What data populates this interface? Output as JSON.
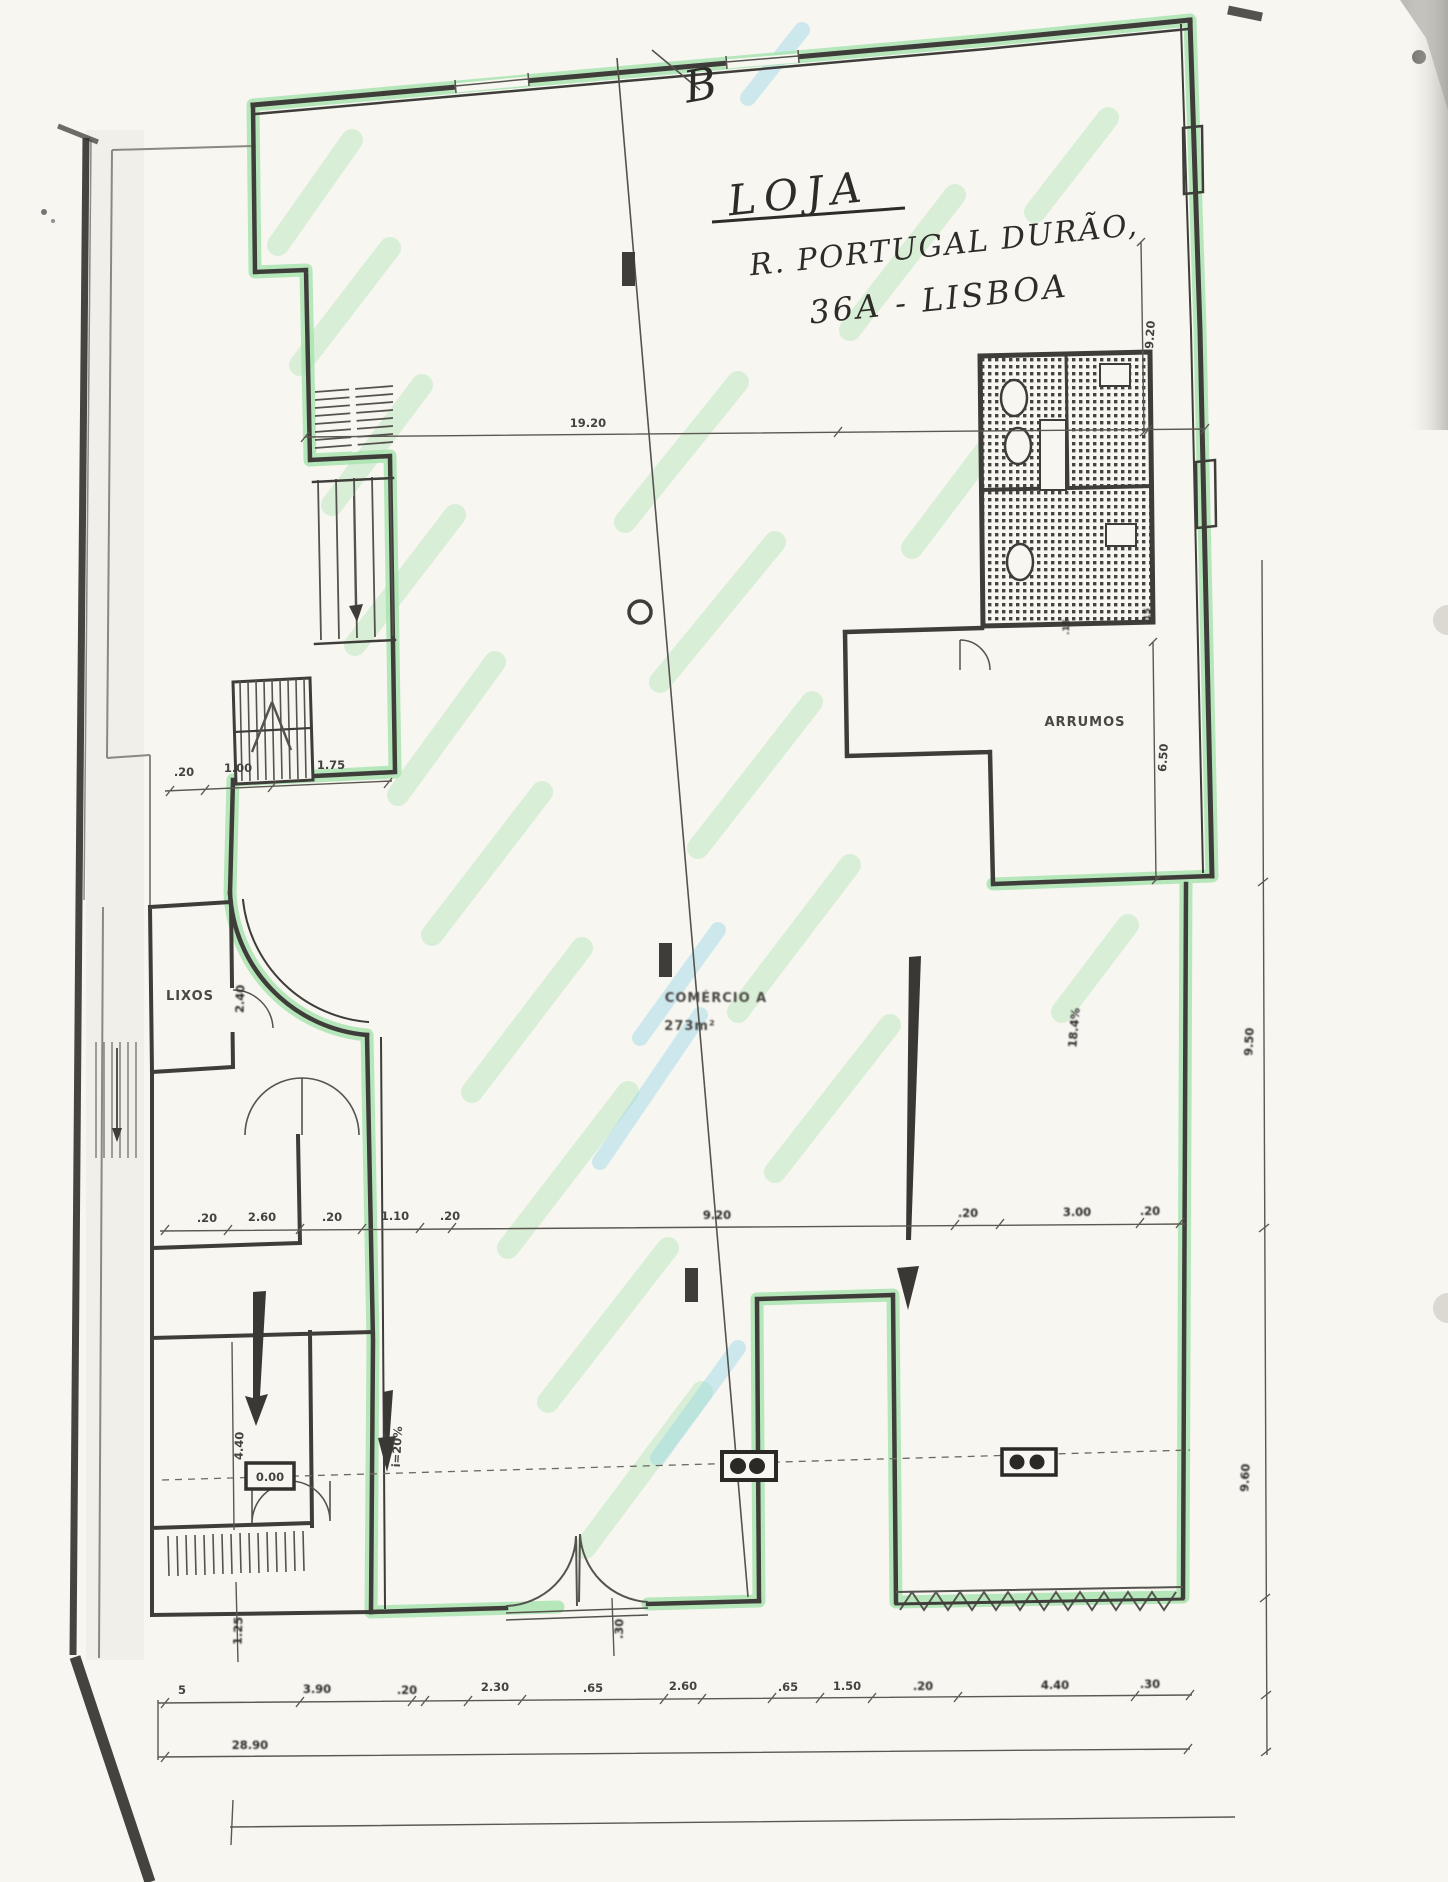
{
  "plan": {
    "handwritten": {
      "title": "LOJA",
      "address1": "R. PORTUGAL DURÃO,",
      "address2": "36A - LISBOA",
      "section_mark": "B"
    },
    "rooms": {
      "storage": "ARRUMOS",
      "trash": "LIXOS",
      "commerce": "COMÉRCIO A",
      "commerce_area": "273m²"
    },
    "levels": {
      "ground": "0.00"
    },
    "slopes": {
      "left_ramp": "i=20%",
      "right_ramp": "18.4%"
    },
    "dims": {
      "top_span": "19.20",
      "upper_left": [
        ".20",
        "1.00",
        "1.75"
      ],
      "middle": [
        ".20",
        "2.60",
        ".20",
        "1.10",
        ".20",
        "9.20",
        ".20",
        "3.00",
        ".20"
      ],
      "bottom": [
        "5",
        "3.90",
        ".20",
        "2.30",
        ".65",
        "2.60",
        ".65",
        "1.50",
        ".20",
        "4.40",
        ".30"
      ],
      "bottom_total": "28.90",
      "right": {
        "upper": "9.20",
        "arrumos": "6.50",
        "lower_upper": "9.50",
        "lower_lower": "9.60"
      },
      "left": {
        "lixos": "2.40",
        "room": "4.40",
        "bottom": "1.25"
      },
      "door": ".30",
      "wall": ".15"
    },
    "colors": {
      "highlight_green": "#a5e3ae",
      "highlight_cyan": "#8fd4e8",
      "ink": "#3f3d39",
      "paper": "#f7f6f1"
    }
  }
}
